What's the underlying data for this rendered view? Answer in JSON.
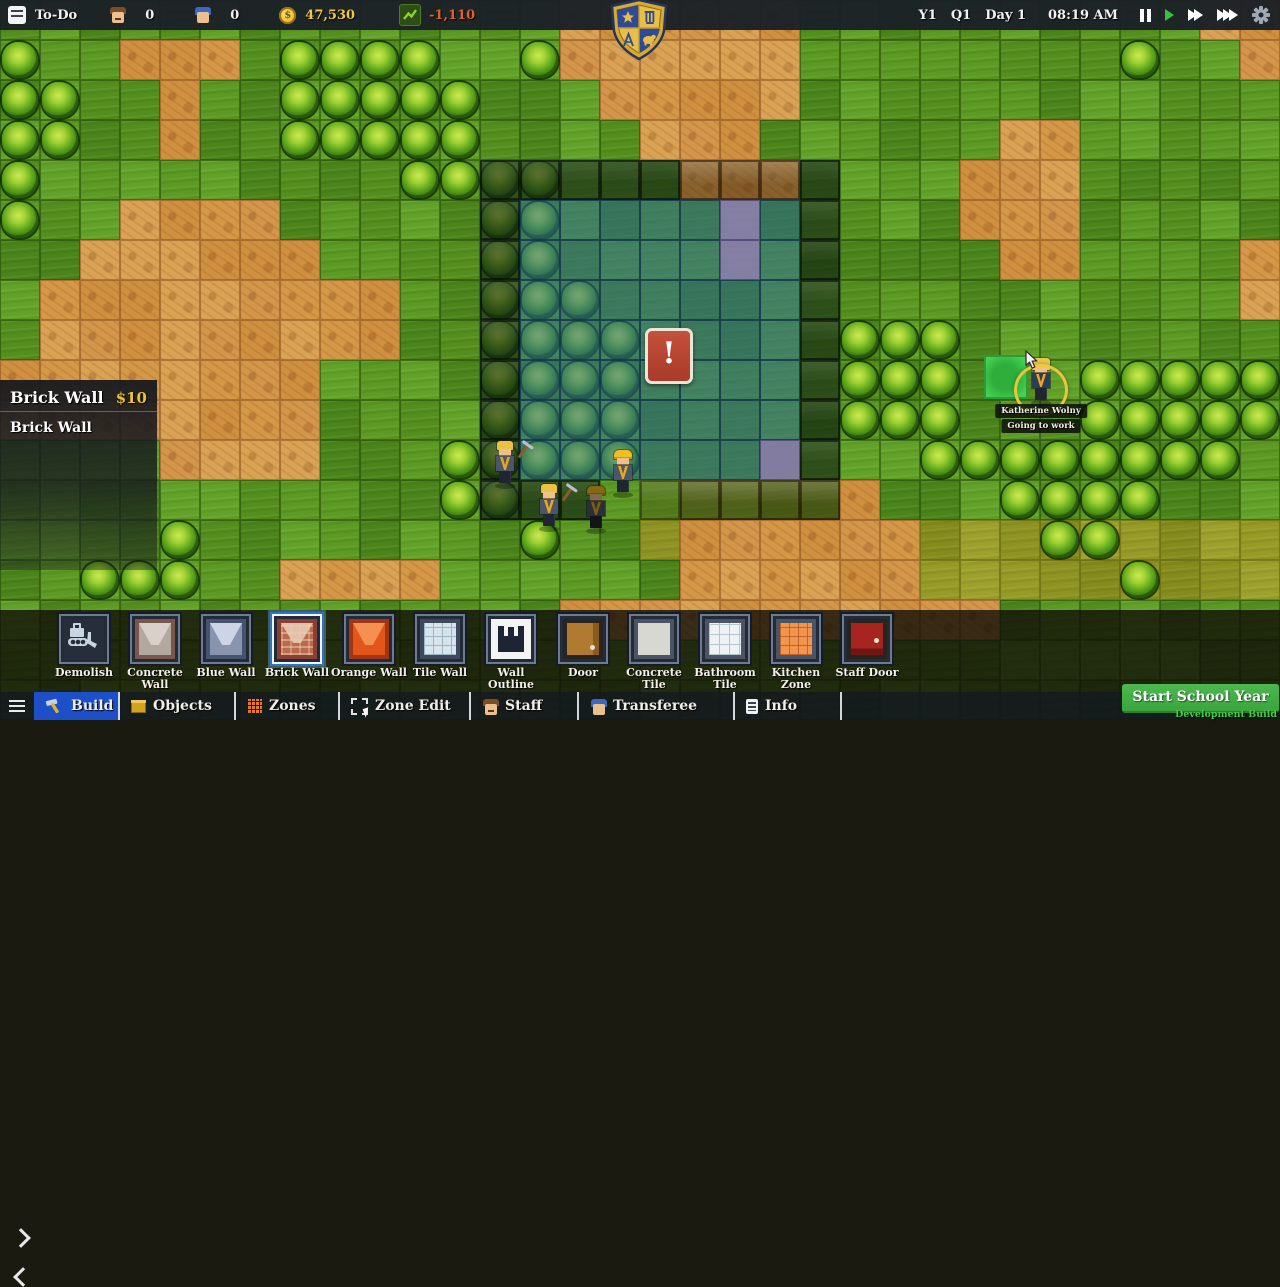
{
  "top_bar": {
    "todo_label": "To-Do",
    "teacher_count": "0",
    "student_count": "0",
    "coin_symbol": "$",
    "money": "47,530",
    "money_delta": "-1,110",
    "year": "Y1",
    "quarter": "Q1",
    "day": "Day 1",
    "time": "08:19 AM"
  },
  "selection_panel": {
    "title": "Brick Wall",
    "price": "$10",
    "description": "Brick Wall"
  },
  "map_tooltip": {
    "name": "Katherine Wolny",
    "status": "Going to work"
  },
  "warning_symbol": "!",
  "build_toolbar": {
    "items": [
      {
        "label": "Demolish",
        "icon": "demolish",
        "selected": false
      },
      {
        "label": "Concrete Wall",
        "icon": "concrete-wall",
        "selected": false
      },
      {
        "label": "Blue Wall",
        "icon": "blue-wall",
        "selected": false
      },
      {
        "label": "Brick Wall",
        "icon": "brick-wall",
        "selected": true
      },
      {
        "label": "Orange Wall",
        "icon": "orange-wall",
        "selected": false
      },
      {
        "label": "Tile Wall",
        "icon": "tile-wall",
        "selected": false
      },
      {
        "label": "Wall Outline",
        "icon": "wall-outline",
        "selected": false
      },
      {
        "label": "Door",
        "icon": "door",
        "selected": false
      },
      {
        "label": "Concrete Tile",
        "icon": "concrete-tile",
        "selected": false
      },
      {
        "label": "Bathroom Tile",
        "icon": "bathroom-tile",
        "selected": false
      },
      {
        "label": "Kitchen Zone",
        "icon": "kitchen-zone",
        "selected": false
      },
      {
        "label": "Staff Door",
        "icon": "staff-door",
        "selected": false
      }
    ]
  },
  "tabs": {
    "items": [
      {
        "name": "menu",
        "label": "",
        "icon": "menu",
        "active": false
      },
      {
        "name": "build",
        "label": "Build",
        "icon": "build",
        "active": true
      },
      {
        "name": "objects",
        "label": "Objects",
        "icon": "objects",
        "active": false
      },
      {
        "name": "zones",
        "label": "Zones",
        "icon": "zones",
        "active": false
      },
      {
        "name": "zone-edit",
        "label": "Zone Edit",
        "icon": "zone-edit",
        "active": false
      },
      {
        "name": "staff",
        "label": "Staff",
        "icon": "staff",
        "active": false
      },
      {
        "name": "transferee",
        "label": "Transferee",
        "icon": "transferee",
        "active": false
      },
      {
        "name": "info",
        "label": "Info",
        "icon": "info",
        "active": false
      }
    ]
  },
  "footer": {
    "start_button": "Start School Year",
    "dev_build": "Development Build"
  },
  "colors": {
    "active_tab_blue": "#1d50c8",
    "money_gold": "#f2c93c",
    "delta_loss_orange": "#e2622b",
    "start_button_green": "#43ad49",
    "dev_build_green": "#3fd13f",
    "blueprint_blue": "#266694",
    "plan_purple": "#897ab4",
    "selection_green": "#45d153",
    "warning_red": "#b5402e"
  },
  "map": {
    "legend": {
      "G": "grass",
      "D": "dirt",
      "Y": "dry-grass",
      "B": "bush",
      "W": "planned-wall",
      "V": "planned-wall-over-bush",
      "T": "planned-wall-over-dirt",
      "F": "planned-floor",
      "U": "planned-floor-over-bush",
      "P": "planned-door",
      "O": "planned-wall-light",
      ".": "none"
    },
    "ground": [
      "GGGGGGGGGGGGGGDDDDDDGGGGGGGGGGDD",
      "GGGDDDGGGGGGGGDDDDDDGGGGGGGGGGGD",
      "GGGGDGGGGGGGGGGDDDDDGGGGGGGGGGGG",
      "GGGGDGGGGGGGGGGGDDDGGGGGGDDGGGGG",
      "GGGGGGGGGGGGGGGGGDDDGGGGDDDGGGGG",
      "GGGDDDDGGGGGGGGGGGGGGGGGDDDGGGGG",
      "GGDDDDDDGGGGGGGGGGGGGGGGGDDGGGGD",
      "GDDDDDDDDDGGGGGGGGGGGGGGGGGGGGGD",
      "GDDDDDDDDDGGGGGGGGGGGGGGGGGGGGGG",
      "DDDDDDDDGGGGGGGGGGGGGGGGGGGGGGGG",
      "DDDDDDDDGGGGGGGGGGGGGGGGGGGGGGGG",
      "GGGGDDDDGGGGGGGGGGGGGGGGGGGGGGGG",
      "GGGGGGGGGGGGGGGGGGGGGDGGGGGGGGGG",
      "GGGGGGGGGGGGGGGGYDDDDDDYYYYYYYYY",
      "GGGGGGGDDDDGGGGGGDDDDDDYYYYYYYYY",
      "GGGGGGGGGGGGGGDDDDDDDDDDDGGGGGGG",
      "GGGGGGGGGGGGGGGGGGGGGGGGGGGGGGGG",
      "GGGGGGGGGGGGGGGGGGGGGGGGGGGGGGGG"
    ],
    "features": [
      "................................",
      "B......BBBB..B..............B...",
      "BB.....BBBBB....................",
      "BB.....BBBBB....................",
      "B.........BBVVWWWTTTW...........",
      "B...........VUFFFFPFW...........",
      "............VUFFFFPFW...........",
      "............VUUFFFFFW...........",
      "............VUUUFFFFWBBB........",
      "............VUUUFFFFWBBB...BBBBB",
      "............VUUUFFFFWBBB...BBBBB",
      "...........BVUUUFFFPW..BBBBBBBB.",
      "...........BVWW.OTTTT....BBBB...",
      "....B........B............BB....",
      "..BBB.......................B...",
      "................................",
      "................................",
      "................................"
    ]
  },
  "characters": [
    {
      "x": 492,
      "y": 441,
      "kind": "worker",
      "hat": false,
      "tool": true,
      "shadow": false
    },
    {
      "x": 536,
      "y": 484,
      "kind": "worker",
      "hat": false,
      "tool": true,
      "shadow": false
    },
    {
      "x": 583,
      "y": 486,
      "kind": "worker",
      "hat": true,
      "tool": false,
      "shadow": true
    },
    {
      "x": 610,
      "y": 450,
      "kind": "worker",
      "hat": true,
      "tool": false,
      "shadow": false
    },
    {
      "x": 1028,
      "y": 358,
      "kind": "katherine",
      "hat": false,
      "tool": false,
      "shadow": false
    }
  ]
}
